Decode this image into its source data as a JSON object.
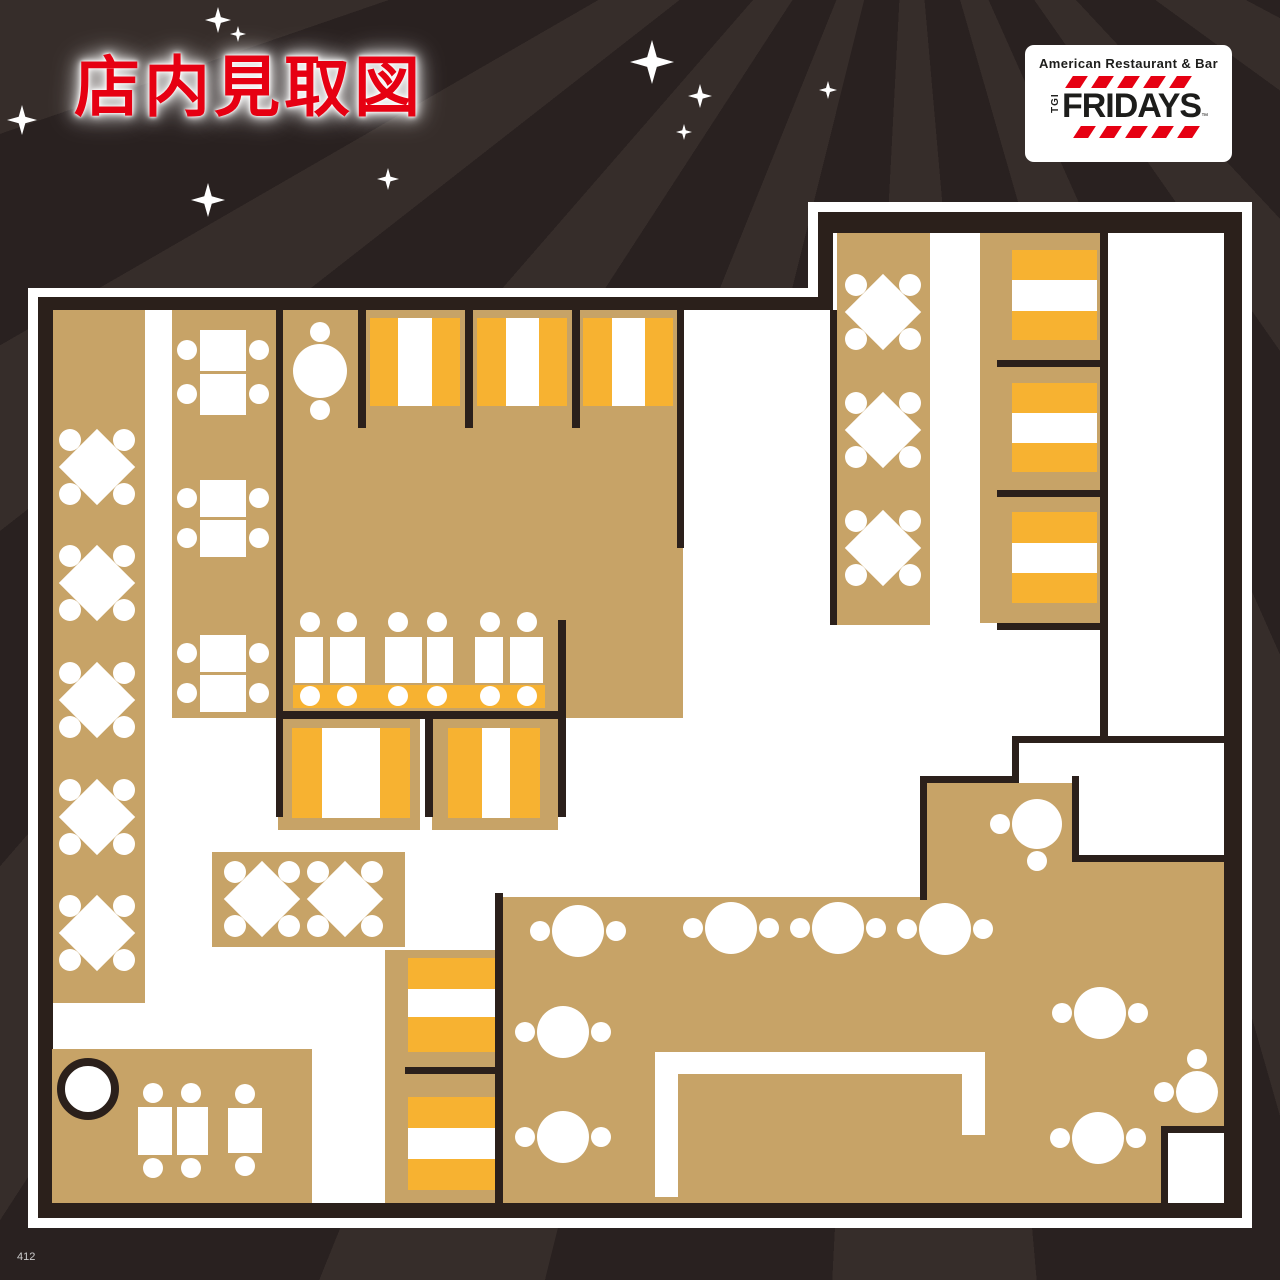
{
  "title": {
    "text": "店内見取図"
  },
  "page_number": "412",
  "logo": {
    "tagline": "American Restaurant & Bar",
    "tgi": "TGI",
    "name": "FRIDAYS",
    "tm": "™"
  },
  "colors": {
    "red": "#e60012",
    "wall": "#2b201b",
    "tan": "#c7a367",
    "orange": "#f7b231",
    "floor": "#ffffff",
    "border": "#ffffff",
    "bg": "#292120",
    "bg_stripe": "#362d2a",
    "logo_text": "#1d1d1b",
    "page_text": "#cccccc"
  },
  "background": {
    "stars": [
      [
        218,
        20,
        13
      ],
      [
        238,
        34,
        8
      ],
      [
        22,
        120,
        15
      ],
      [
        208,
        200,
        17
      ],
      [
        388,
        179,
        11
      ],
      [
        652,
        62,
        22
      ],
      [
        700,
        96,
        12
      ],
      [
        684,
        132,
        8
      ],
      [
        828,
        90,
        9
      ]
    ]
  },
  "plan": {
    "outline": {
      "outer": [
        [
          28,
          288
        ],
        [
          808,
          288
        ],
        [
          808,
          202
        ],
        [
          1252,
          202
        ],
        [
          1252,
          1228
        ],
        [
          28,
          1228
        ]
      ],
      "wall": [
        [
          38,
          297
        ],
        [
          818,
          297
        ],
        [
          818,
          212
        ],
        [
          1242,
          212
        ],
        [
          1242,
          1218
        ],
        [
          38,
          1218
        ]
      ],
      "floor": [
        [
          53,
          310
        ],
        [
          833,
          310
        ],
        [
          833,
          233
        ],
        [
          1224,
          233
        ],
        [
          1224,
          1203
        ],
        [
          53,
          1203
        ]
      ]
    },
    "tan_areas": [
      {
        "n": "left-diamond-strip",
        "x": 53,
        "y": 310,
        "w": 92,
        "h": 693
      },
      {
        "n": "left-table-strip",
        "x": 172,
        "y": 310,
        "w": 105,
        "h": 408
      },
      {
        "n": "central-room-upper",
        "x": 283,
        "y": 310,
        "w": 394,
        "h": 240
      },
      {
        "n": "central-room-lower",
        "x": 283,
        "y": 548,
        "w": 400,
        "h": 170
      },
      {
        "n": "right-diamond-strip",
        "x": 837,
        "y": 233,
        "w": 93,
        "h": 392
      },
      {
        "n": "right-booth-strip",
        "x": 980,
        "y": 233,
        "w": 120,
        "h": 390
      },
      {
        "n": "lower-booth-left",
        "x": 278,
        "y": 718,
        "w": 142,
        "h": 112
      },
      {
        "n": "lower-booth-right",
        "x": 432,
        "y": 718,
        "w": 126,
        "h": 112
      },
      {
        "n": "diamond-table-block",
        "x": 212,
        "y": 852,
        "w": 193,
        "h": 95
      },
      {
        "n": "bottom-booth-strip",
        "x": 385,
        "y": 950,
        "w": 115,
        "h": 253
      },
      {
        "n": "bottom-left-block",
        "x": 52,
        "y": 1049,
        "w": 260,
        "h": 154
      },
      {
        "n": "bottom-right-main",
        "x": 503,
        "y": 897,
        "w": 721,
        "h": 306
      },
      {
        "n": "bottom-right-step",
        "x": 926,
        "y": 783,
        "w": 146,
        "h": 117
      },
      {
        "n": "bottom-right-shelf",
        "x": 1072,
        "y": 862,
        "w": 152,
        "h": 38
      }
    ],
    "walls": [
      {
        "n": "wall-strip-divider",
        "x": 276,
        "y": 310,
        "w": 7,
        "h": 507
      },
      {
        "n": "wall-booth-div-1",
        "x": 358,
        "y": 310,
        "w": 8,
        "h": 118
      },
      {
        "n": "wall-booth-div-2",
        "x": 465,
        "y": 310,
        "w": 8,
        "h": 118
      },
      {
        "n": "wall-booth-div-3",
        "x": 572,
        "y": 310,
        "w": 8,
        "h": 118
      },
      {
        "n": "wall-central-right",
        "x": 677,
        "y": 310,
        "w": 7,
        "h": 238
      },
      {
        "n": "wall-central-bottom",
        "x": 276,
        "y": 711,
        "w": 289,
        "h": 8
      },
      {
        "n": "wall-lower-booth-mid",
        "x": 425,
        "y": 711,
        "w": 8,
        "h": 106
      },
      {
        "n": "wall-lower-booth-right",
        "x": 558,
        "y": 620,
        "w": 8,
        "h": 197
      },
      {
        "n": "wall-right-strip-left",
        "x": 830,
        "y": 310,
        "w": 7,
        "h": 315
      },
      {
        "n": "wall-right-booth-right",
        "x": 1100,
        "y": 227,
        "w": 8,
        "h": 516
      },
      {
        "n": "wall-right-booth-div-1",
        "x": 997,
        "y": 360,
        "w": 103,
        "h": 7
      },
      {
        "n": "wall-right-booth-div-2",
        "x": 997,
        "y": 490,
        "w": 103,
        "h": 7
      },
      {
        "n": "wall-right-booth-bottom",
        "x": 997,
        "y": 623,
        "w": 111,
        "h": 7
      },
      {
        "n": "wall-mid-right",
        "x": 1012,
        "y": 736,
        "w": 212,
        "h": 7
      },
      {
        "n": "wall-step-a",
        "x": 1012,
        "y": 736,
        "w": 7,
        "h": 47
      },
      {
        "n": "wall-step-b",
        "x": 920,
        "y": 776,
        "w": 99,
        "h": 7
      },
      {
        "n": "wall-step-c",
        "x": 920,
        "y": 776,
        "w": 7,
        "h": 124
      },
      {
        "n": "wall-room-left",
        "x": 1072,
        "y": 776,
        "w": 7,
        "h": 86
      },
      {
        "n": "wall-room-bottom",
        "x": 1072,
        "y": 855,
        "w": 152,
        "h": 7
      },
      {
        "n": "wall-br-left",
        "x": 495,
        "y": 893,
        "w": 8,
        "h": 310
      },
      {
        "n": "wall-bottom-booth-div",
        "x": 405,
        "y": 1067,
        "w": 97,
        "h": 7
      },
      {
        "n": "wall-corner-room-left",
        "x": 1161,
        "y": 1126,
        "w": 7,
        "h": 77
      },
      {
        "n": "wall-corner-room-top",
        "x": 1161,
        "y": 1126,
        "w": 63,
        "h": 7
      }
    ],
    "white_rooms": [
      {
        "n": "corner-room",
        "x": 1168,
        "y": 1133,
        "w": 56,
        "h": 70
      }
    ],
    "benches": [
      {
        "n": "booth-bench",
        "x": 370,
        "y": 318,
        "w": 90,
        "h": 88
      },
      {
        "n": "booth-bench",
        "x": 477,
        "y": 318,
        "w": 90,
        "h": 88
      },
      {
        "n": "booth-bench",
        "x": 583,
        "y": 318,
        "w": 90,
        "h": 88
      },
      {
        "n": "booth-bench",
        "x": 1012,
        "y": 250,
        "w": 85,
        "h": 90
      },
      {
        "n": "booth-bench",
        "x": 1012,
        "y": 383,
        "w": 85,
        "h": 89
      },
      {
        "n": "booth-bench",
        "x": 1012,
        "y": 512,
        "w": 85,
        "h": 91
      },
      {
        "n": "booth-bench",
        "x": 292,
        "y": 728,
        "w": 118,
        "h": 90
      },
      {
        "n": "booth-bench",
        "x": 448,
        "y": 728,
        "w": 92,
        "h": 90
      },
      {
        "n": "booth-bench",
        "x": 408,
        "y": 958,
        "w": 87,
        "h": 94
      },
      {
        "n": "booth-bench",
        "x": 408,
        "y": 1097,
        "w": 87,
        "h": 93
      },
      {
        "n": "dining-bench",
        "x": 293,
        "y": 685,
        "w": 252,
        "h": 23
      }
    ],
    "booth_tables": [
      {
        "x": 398,
        "y": 318,
        "w": 34,
        "h": 88
      },
      {
        "x": 506,
        "y": 318,
        "w": 33,
        "h": 88
      },
      {
        "x": 612,
        "y": 318,
        "w": 33,
        "h": 88
      },
      {
        "x": 1012,
        "y": 280,
        "w": 85,
        "h": 31
      },
      {
        "x": 1012,
        "y": 413,
        "w": 85,
        "h": 30
      },
      {
        "x": 1012,
        "y": 543,
        "w": 85,
        "h": 30
      },
      {
        "x": 322,
        "y": 728,
        "w": 58,
        "h": 90
      },
      {
        "x": 482,
        "y": 728,
        "w": 28,
        "h": 90
      },
      {
        "x": 408,
        "y": 989,
        "w": 87,
        "h": 28
      },
      {
        "x": 408,
        "y": 1128,
        "w": 87,
        "h": 31
      }
    ],
    "tables": [
      {
        "x": 200,
        "y": 330,
        "w": 46,
        "h": 41
      },
      {
        "x": 200,
        "y": 374,
        "w": 46,
        "h": 41
      },
      {
        "x": 200,
        "y": 480,
        "w": 46,
        "h": 37
      },
      {
        "x": 200,
        "y": 520,
        "w": 46,
        "h": 37
      },
      {
        "x": 200,
        "y": 635,
        "w": 46,
        "h": 37
      },
      {
        "x": 200,
        "y": 675,
        "w": 46,
        "h": 37
      },
      {
        "x": 295,
        "y": 637,
        "w": 28,
        "h": 46
      },
      {
        "x": 330,
        "y": 637,
        "w": 35,
        "h": 46
      },
      {
        "x": 385,
        "y": 637,
        "w": 37,
        "h": 46
      },
      {
        "x": 427,
        "y": 637,
        "w": 26,
        "h": 46
      },
      {
        "x": 475,
        "y": 637,
        "w": 28,
        "h": 46
      },
      {
        "x": 510,
        "y": 637,
        "w": 33,
        "h": 46
      },
      {
        "x": 138,
        "y": 1107,
        "w": 34,
        "h": 48
      },
      {
        "x": 177,
        "y": 1107,
        "w": 31,
        "h": 48
      },
      {
        "x": 228,
        "y": 1108,
        "w": 34,
        "h": 45
      },
      {
        "n": "counter",
        "x": 655,
        "y": 1052,
        "w": 330,
        "h": 22
      },
      {
        "n": "counter",
        "x": 655,
        "y": 1052,
        "w": 23,
        "h": 145
      },
      {
        "n": "counter",
        "x": 962,
        "y": 1052,
        "w": 23,
        "h": 83
      }
    ],
    "chairs": [
      [
        187,
        350
      ],
      [
        259,
        350
      ],
      [
        187,
        394
      ],
      [
        259,
        394
      ],
      [
        187,
        498
      ],
      [
        259,
        498
      ],
      [
        187,
        538
      ],
      [
        259,
        538
      ],
      [
        187,
        653
      ],
      [
        259,
        653
      ],
      [
        187,
        693
      ],
      [
        259,
        693
      ],
      [
        310,
        622
      ],
      [
        347,
        622
      ],
      [
        398,
        622
      ],
      [
        437,
        622
      ],
      [
        490,
        622
      ],
      [
        527,
        622
      ],
      [
        310,
        696
      ],
      [
        347,
        696
      ],
      [
        398,
        696
      ],
      [
        437,
        696
      ],
      [
        490,
        696
      ],
      [
        527,
        696
      ],
      [
        153,
        1093
      ],
      [
        191,
        1093
      ],
      [
        245,
        1094
      ],
      [
        153,
        1168
      ],
      [
        191,
        1168
      ],
      [
        245,
        1166
      ]
    ],
    "round_tables": [
      {
        "cx": 320,
        "cy": 371,
        "r": 27,
        "ch": [
          "t",
          "b"
        ]
      },
      {
        "cx": 578,
        "cy": 931,
        "r": 26,
        "ch": [
          "l",
          "r"
        ]
      },
      {
        "cx": 731,
        "cy": 928,
        "r": 26,
        "ch": [
          "l",
          "r"
        ]
      },
      {
        "cx": 838,
        "cy": 928,
        "r": 26,
        "ch": [
          "l",
          "r"
        ]
      },
      {
        "cx": 945,
        "cy": 929,
        "r": 26,
        "ch": [
          "l",
          "r"
        ]
      },
      {
        "cx": 563,
        "cy": 1032,
        "r": 26,
        "ch": [
          "l",
          "r"
        ]
      },
      {
        "cx": 563,
        "cy": 1137,
        "r": 26,
        "ch": [
          "l",
          "r"
        ]
      },
      {
        "cx": 1037,
        "cy": 824,
        "r": 25,
        "ch": [
          "l",
          "b"
        ]
      },
      {
        "cx": 1100,
        "cy": 1013,
        "r": 26,
        "ch": [
          "l",
          "r"
        ]
      },
      {
        "cx": 1098,
        "cy": 1138,
        "r": 26,
        "ch": [
          "l",
          "r"
        ]
      },
      {
        "cx": 1197,
        "cy": 1092,
        "r": 21,
        "ch": [
          "t",
          "l"
        ]
      }
    ],
    "diamond_tables": [
      {
        "cx": 97,
        "cy": 467
      },
      {
        "cx": 97,
        "cy": 583
      },
      {
        "cx": 97,
        "cy": 700
      },
      {
        "cx": 97,
        "cy": 817
      },
      {
        "cx": 97,
        "cy": 933
      },
      {
        "cx": 262,
        "cy": 899
      },
      {
        "cx": 345,
        "cy": 899
      },
      {
        "cx": 883,
        "cy": 312
      },
      {
        "cx": 883,
        "cy": 430
      },
      {
        "cx": 883,
        "cy": 548
      }
    ],
    "ring_tables": [
      {
        "cx": 88,
        "cy": 1089,
        "r": 31
      }
    ]
  }
}
